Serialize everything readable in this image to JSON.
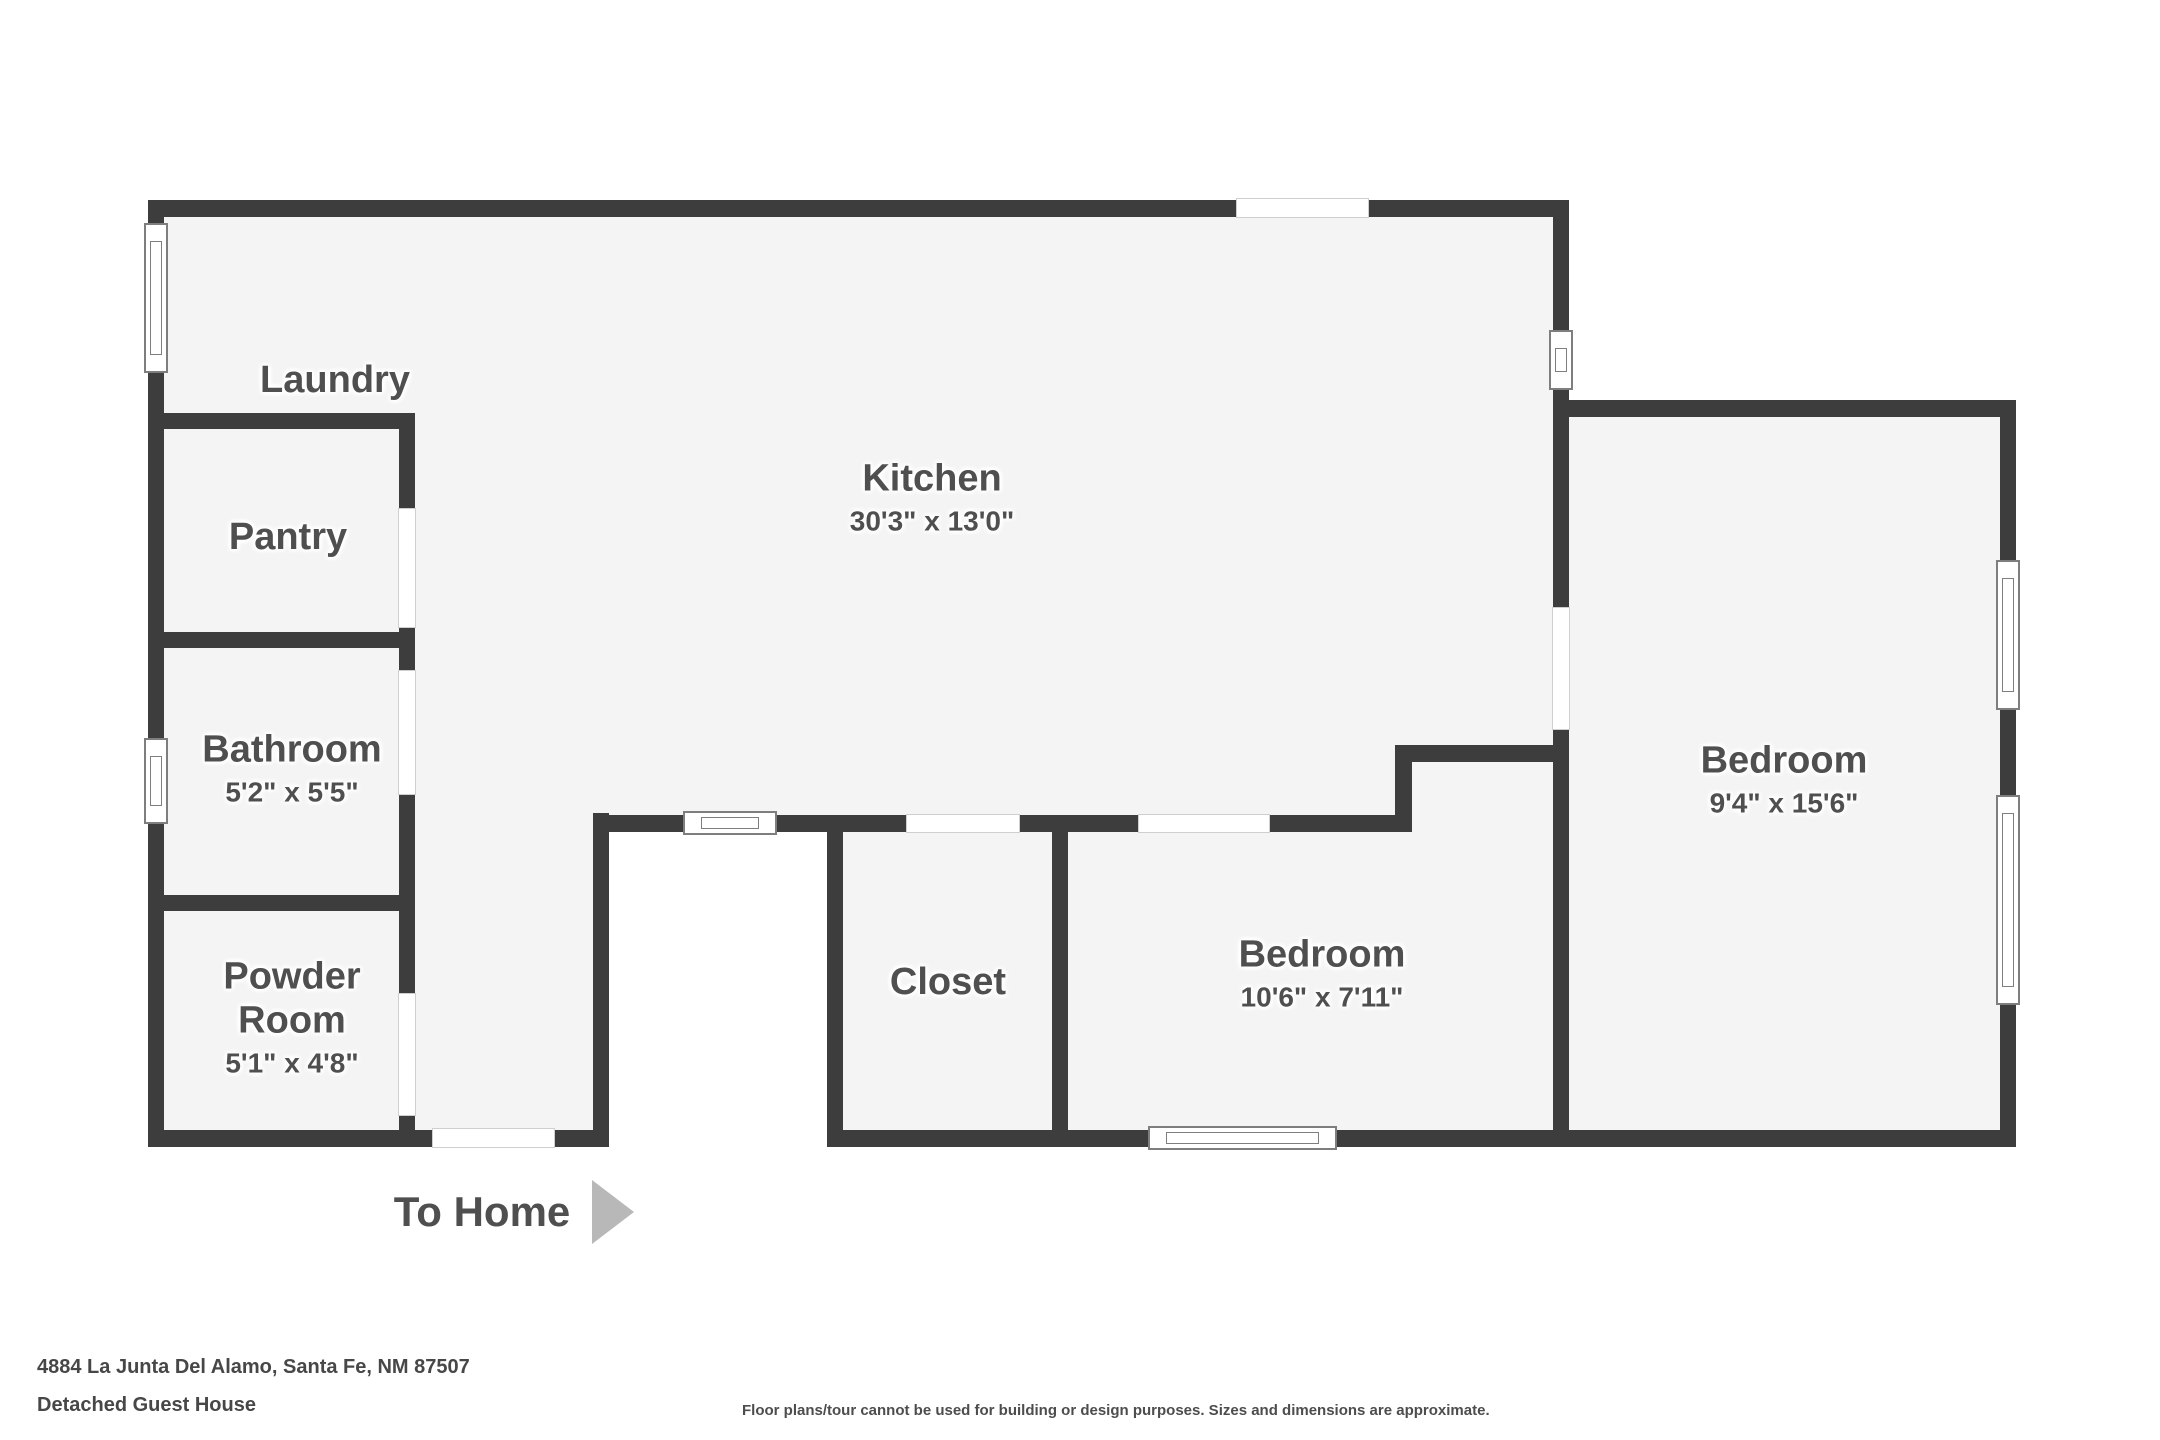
{
  "title": "Detached guest house floor plan",
  "floorplan": {
    "rooms": [
      {
        "name": "Laundry",
        "dims": ""
      },
      {
        "name": "Pantry",
        "dims": ""
      },
      {
        "name": "Bathroom",
        "dims": "5'2\" x 5'5\""
      },
      {
        "name": "Powder Room",
        "dims": "5'1\" x 4'8\""
      },
      {
        "name": "Kitchen",
        "dims": "30'3\" x 13'0\""
      },
      {
        "name": "Closet",
        "dims": ""
      },
      {
        "name": "Bedroom",
        "dims": "10'6\" x 7'11\""
      },
      {
        "name": "Bedroom",
        "dims": "9'4\" x 15'6\""
      }
    ],
    "exit_label": "To Home",
    "exit_arrow_icon": "right-triangle-arrow"
  },
  "footer": {
    "address": "4884 La Junta Del Alamo, Santa Fe, NM 87507",
    "subtitle": "Detached Guest House",
    "disclaimer": "Floor plans/tour cannot be used for building or design purposes. Sizes and dimensions are approximate."
  },
  "colors": {
    "wall": "#3d3d3d",
    "room_fill": "#f4f4f4",
    "label_text": "#4f4f4f",
    "arrow": "#b8b8b8",
    "background": "#ffffff"
  }
}
